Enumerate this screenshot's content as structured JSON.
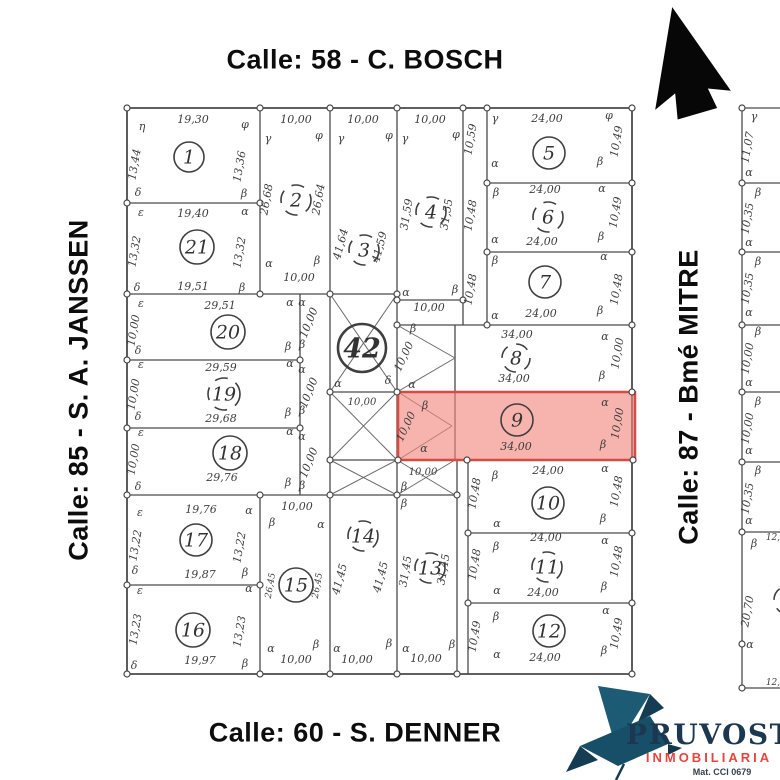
{
  "streets": {
    "top": "Calle: 58 - C. BOSCH",
    "left": "Calle: 85 - S. A. JANSSEN",
    "right": "Calle: 87 - Bmé MITRE",
    "bottom": "Calle: 60 - S. DENNER"
  },
  "logo": {
    "name": "PRUVOST",
    "subtitle": "INMOBILIARIA",
    "registration": "Mat. CCI 0679",
    "navy": "#1c3850",
    "red": "#e8443c",
    "teal": "#1d5a74"
  },
  "icons": {
    "north_arrow": "solid-block-arrow-up",
    "logo_bird": "origami-bird"
  },
  "map": {
    "highlighted_lot": "9",
    "highlight_fill": "#f2857b",
    "highlight_stroke": "#d84b42",
    "line_color": "#4a4a4a",
    "label_color": "#3d3d3d",
    "lots": [
      {
        "n": "1",
        "x": 189,
        "y": 157,
        "r": 15,
        "style": "solid"
      },
      {
        "n": "21",
        "x": 197,
        "y": 247,
        "r": 17,
        "style": "solid"
      },
      {
        "n": "2",
        "x": 296,
        "y": 200,
        "r": 15,
        "style": "dashed"
      },
      {
        "n": "3",
        "x": 364,
        "y": 250,
        "r": 15,
        "style": "dashed"
      },
      {
        "n": "4",
        "x": 431,
        "y": 212,
        "r": 15,
        "style": "dashed"
      },
      {
        "n": "5",
        "x": 549,
        "y": 153,
        "r": 16,
        "style": "solid"
      },
      {
        "n": "6",
        "x": 548,
        "y": 217,
        "r": 15,
        "style": "dashed"
      },
      {
        "n": "7",
        "x": 545,
        "y": 282,
        "r": 16,
        "style": "solid"
      },
      {
        "n": "42",
        "x": 362,
        "y": 348,
        "r": 24,
        "style": "bold"
      },
      {
        "n": "8",
        "x": 516,
        "y": 358,
        "r": 14,
        "style": "dashed"
      },
      {
        "n": "9",
        "x": 517,
        "y": 420,
        "r": 16,
        "style": "solid"
      },
      {
        "n": "10",
        "x": 548,
        "y": 503,
        "r": 16,
        "style": "solid"
      },
      {
        "n": "11",
        "x": 547,
        "y": 567,
        "r": 15,
        "style": "dashed"
      },
      {
        "n": "12",
        "x": 549,
        "y": 631,
        "r": 16,
        "style": "solid"
      },
      {
        "n": "13",
        "x": 430,
        "y": 568,
        "r": 15,
        "style": "dashed"
      },
      {
        "n": "14",
        "x": 363,
        "y": 536,
        "r": 15,
        "style": "dashed"
      },
      {
        "n": "15",
        "x": 296,
        "y": 585,
        "r": 17,
        "style": "solid"
      },
      {
        "n": "16",
        "x": 193,
        "y": 630,
        "r": 17,
        "style": "solid"
      },
      {
        "n": "17",
        "x": 196,
        "y": 540,
        "r": 16,
        "style": "solid"
      },
      {
        "n": "18",
        "x": 230,
        "y": 453,
        "r": 17,
        "style": "solid"
      },
      {
        "n": "19",
        "x": 224,
        "y": 394,
        "r": 16,
        "style": "dashed"
      },
      {
        "n": "20",
        "x": 228,
        "y": 332,
        "r": 17,
        "style": "solid"
      }
    ],
    "labels": [
      {
        "t": "19,30",
        "x": 193,
        "y": 123
      },
      {
        "t": "13,44",
        "x": 138,
        "y": 165,
        "r": -80
      },
      {
        "t": "13,36",
        "x": 243,
        "y": 167,
        "r": -80
      },
      {
        "t": "η",
        "x": 142,
        "y": 130
      },
      {
        "t": "φ",
        "x": 245,
        "y": 128
      },
      {
        "t": "δ",
        "x": 138,
        "y": 196
      },
      {
        "t": "β",
        "x": 244,
        "y": 197
      },
      {
        "t": "19,40",
        "x": 193,
        "y": 217
      },
      {
        "t": "19,51",
        "x": 193,
        "y": 290
      },
      {
        "t": "13,32",
        "x": 138,
        "y": 252,
        "r": -80
      },
      {
        "t": "13,32",
        "x": 243,
        "y": 253,
        "r": -80
      },
      {
        "t": "ε",
        "x": 141,
        "y": 216
      },
      {
        "t": "α",
        "x": 245,
        "y": 215
      },
      {
        "t": "δ",
        "x": 137,
        "y": 291
      },
      {
        "t": "β",
        "x": 242,
        "y": 291
      },
      {
        "t": "10,00",
        "x": 296,
        "y": 123
      },
      {
        "t": "26,68",
        "x": 270,
        "y": 200,
        "r": -80
      },
      {
        "t": "26,64",
        "x": 322,
        "y": 200,
        "r": -80
      },
      {
        "t": "10,00",
        "x": 299,
        "y": 281
      },
      {
        "t": "γ",
        "x": 268,
        "y": 142
      },
      {
        "t": "φ",
        "x": 319,
        "y": 139
      },
      {
        "t": "α",
        "x": 269,
        "y": 267
      },
      {
        "t": "β",
        "x": 317,
        "y": 264
      },
      {
        "t": "10,00",
        "x": 363,
        "y": 123
      },
      {
        "t": "41,64",
        "x": 344,
        "y": 245,
        "r": -75
      },
      {
        "t": "41,59",
        "x": 383,
        "y": 248,
        "r": -75
      },
      {
        "t": "γ",
        "x": 341,
        "y": 142
      },
      {
        "t": "φ",
        "x": 389,
        "y": 139
      },
      {
        "t": "10,00",
        "x": 430,
        "y": 123
      },
      {
        "t": "31,59",
        "x": 410,
        "y": 215,
        "r": -80
      },
      {
        "t": "31,55",
        "x": 450,
        "y": 215,
        "r": -80
      },
      {
        "t": "γ",
        "x": 405,
        "y": 142
      },
      {
        "t": "φ",
        "x": 456,
        "y": 138
      },
      {
        "t": "α",
        "x": 406,
        "y": 296
      },
      {
        "t": "β",
        "x": 455,
        "y": 293
      },
      {
        "t": "10,00",
        "x": 429,
        "y": 311
      },
      {
        "t": "10,59",
        "x": 474,
        "y": 140,
        "r": -80
      },
      {
        "t": "10,48",
        "x": 474,
        "y": 216,
        "r": -80
      },
      {
        "t": "10,48",
        "x": 474,
        "y": 290,
        "r": -80
      },
      {
        "t": "24,00",
        "x": 547,
        "y": 122
      },
      {
        "t": "10,49",
        "x": 620,
        "y": 142,
        "r": -80
      },
      {
        "t": "γ",
        "x": 495,
        "y": 122
      },
      {
        "t": "φ",
        "x": 609,
        "y": 119
      },
      {
        "t": "α",
        "x": 495,
        "y": 167
      },
      {
        "t": "β",
        "x": 600,
        "y": 165
      },
      {
        "t": "24,00",
        "x": 545,
        "y": 193
      },
      {
        "t": "24,00",
        "x": 542,
        "y": 245
      },
      {
        "t": "10,49",
        "x": 619,
        "y": 213,
        "r": -80
      },
      {
        "t": "β",
        "x": 496,
        "y": 196
      },
      {
        "t": "α",
        "x": 602,
        "y": 192
      },
      {
        "t": "α",
        "x": 495,
        "y": 243
      },
      {
        "t": "β",
        "x": 601,
        "y": 240
      },
      {
        "t": "24,00",
        "x": 541,
        "y": 317
      },
      {
        "t": "10,48",
        "x": 620,
        "y": 290,
        "r": -80
      },
      {
        "t": "β",
        "x": 495,
        "y": 264
      },
      {
        "t": "α",
        "x": 604,
        "y": 260
      },
      {
        "t": "α",
        "x": 495,
        "y": 319
      },
      {
        "t": "β",
        "x": 600,
        "y": 314
      },
      {
        "t": "29,51",
        "x": 220,
        "y": 309
      },
      {
        "t": "10,00",
        "x": 137,
        "y": 331,
        "r": -80
      },
      {
        "t": "ε",
        "x": 141,
        "y": 307
      },
      {
        "t": "α",
        "x": 290,
        "y": 306
      },
      {
        "t": "δ",
        "x": 138,
        "y": 354
      },
      {
        "t": "β",
        "x": 288,
        "y": 350
      },
      {
        "t": "α",
        "x": 302,
        "y": 306
      },
      {
        "t": "10,00",
        "x": 312,
        "y": 324,
        "r": -68
      },
      {
        "t": "β",
        "x": 302,
        "y": 348
      },
      {
        "t": "α",
        "x": 302,
        "y": 373
      },
      {
        "t": "10,00",
        "x": 312,
        "y": 394,
        "r": -68
      },
      {
        "t": "β",
        "x": 302,
        "y": 414
      },
      {
        "t": "α",
        "x": 302,
        "y": 440
      },
      {
        "t": "10,00",
        "x": 312,
        "y": 464,
        "r": -68
      },
      {
        "t": "β",
        "x": 302,
        "y": 489
      },
      {
        "t": "29,59",
        "x": 221,
        "y": 371
      },
      {
        "t": "29,68",
        "x": 221,
        "y": 422
      },
      {
        "t": "10,00",
        "x": 137,
        "y": 395,
        "r": -80
      },
      {
        "t": "ε",
        "x": 141,
        "y": 368
      },
      {
        "t": "α",
        "x": 290,
        "y": 367
      },
      {
        "t": "δ",
        "x": 138,
        "y": 420
      },
      {
        "t": "β",
        "x": 288,
        "y": 416
      },
      {
        "t": "29,76",
        "x": 222,
        "y": 481
      },
      {
        "t": "10,00",
        "x": 137,
        "y": 460,
        "r": -80
      },
      {
        "t": "ε",
        "x": 141,
        "y": 436
      },
      {
        "t": "α",
        "x": 290,
        "y": 435
      },
      {
        "t": "δ",
        "x": 138,
        "y": 490
      },
      {
        "t": "β",
        "x": 288,
        "y": 486
      },
      {
        "t": "19,76",
        "x": 201,
        "y": 513
      },
      {
        "t": "19,87",
        "x": 200,
        "y": 578
      },
      {
        "t": "13,22",
        "x": 139,
        "y": 546,
        "r": -80
      },
      {
        "t": "13,22",
        "x": 243,
        "y": 548,
        "r": -80
      },
      {
        "t": "ε",
        "x": 140,
        "y": 516
      },
      {
        "t": "α",
        "x": 249,
        "y": 514
      },
      {
        "t": "δ",
        "x": 135,
        "y": 574
      },
      {
        "t": "β",
        "x": 245,
        "y": 576
      },
      {
        "t": "19,97",
        "x": 200,
        "y": 664
      },
      {
        "t": "13,23",
        "x": 139,
        "y": 630,
        "r": -80
      },
      {
        "t": "13,23",
        "x": 243,
        "y": 632,
        "r": -80
      },
      {
        "t": "ε",
        "x": 140,
        "y": 594
      },
      {
        "t": "α",
        "x": 249,
        "y": 592
      },
      {
        "t": "δ",
        "x": 134,
        "y": 669
      },
      {
        "t": "β",
        "x": 245,
        "y": 667
      },
      {
        "t": "10,00",
        "x": 297,
        "y": 510
      },
      {
        "t": "10,00",
        "x": 296,
        "y": 663
      },
      {
        "t": "26,45",
        "x": 273,
        "y": 586,
        "r": -80,
        "s": 9
      },
      {
        "t": "26,45",
        "x": 320,
        "y": 586,
        "r": -80,
        "s": 9
      },
      {
        "t": "β",
        "x": 272,
        "y": 526
      },
      {
        "t": "α",
        "x": 321,
        "y": 528
      },
      {
        "t": "α",
        "x": 271,
        "y": 652
      },
      {
        "t": "β",
        "x": 316,
        "y": 648
      },
      {
        "t": "41,45",
        "x": 343,
        "y": 580,
        "r": -75
      },
      {
        "t": "41,45",
        "x": 384,
        "y": 578,
        "r": -75
      },
      {
        "t": "10,00",
        "x": 357,
        "y": 663
      },
      {
        "t": "α",
        "x": 337,
        "y": 652
      },
      {
        "t": "β",
        "x": 389,
        "y": 647
      },
      {
        "t": "31,45",
        "x": 409,
        "y": 572,
        "r": -80
      },
      {
        "t": "31,45",
        "x": 447,
        "y": 570,
        "r": -80
      },
      {
        "t": "10,00",
        "x": 426,
        "y": 662
      },
      {
        "t": "β",
        "x": 404,
        "y": 507
      },
      {
        "t": "α",
        "x": 406,
        "y": 652
      },
      {
        "t": "β",
        "x": 452,
        "y": 648
      },
      {
        "t": "α",
        "x": 338,
        "y": 387
      },
      {
        "t": "δ",
        "x": 388,
        "y": 384
      },
      {
        "t": "10,00",
        "x": 362,
        "y": 405,
        "s": 10
      },
      {
        "t": "β",
        "x": 413,
        "y": 332
      },
      {
        "t": "10,00",
        "x": 407,
        "y": 358,
        "r": -65
      },
      {
        "t": "α",
        "x": 412,
        "y": 388
      },
      {
        "t": "β",
        "x": 425,
        "y": 409
      },
      {
        "t": "10,00",
        "x": 409,
        "y": 428,
        "r": -65
      },
      {
        "t": "α",
        "x": 424,
        "y": 452
      },
      {
        "t": "10,00",
        "x": 423,
        "y": 475,
        "s": 10
      },
      {
        "t": "β",
        "x": 404,
        "y": 490
      },
      {
        "t": "34,00",
        "x": 517,
        "y": 338
      },
      {
        "t": "34,00",
        "x": 514,
        "y": 382
      },
      {
        "t": "10,00",
        "x": 621,
        "y": 354,
        "r": -80
      },
      {
        "t": "α",
        "x": 605,
        "y": 340
      },
      {
        "t": "β",
        "x": 602,
        "y": 379
      },
      {
        "t": "34,00",
        "x": 516,
        "y": 450
      },
      {
        "t": "10,00",
        "x": 621,
        "y": 424,
        "r": -80
      },
      {
        "t": "α",
        "x": 605,
        "y": 406
      },
      {
        "t": "β",
        "x": 603,
        "y": 448
      },
      {
        "t": "24,00",
        "x": 548,
        "y": 474
      },
      {
        "t": "10,48",
        "x": 478,
        "y": 494,
        "r": -80
      },
      {
        "t": "10,48",
        "x": 620,
        "y": 492,
        "r": -80
      },
      {
        "t": "β",
        "x": 495,
        "y": 479
      },
      {
        "t": "α",
        "x": 605,
        "y": 472
      },
      {
        "t": "α",
        "x": 497,
        "y": 527
      },
      {
        "t": "β",
        "x": 603,
        "y": 522
      },
      {
        "t": "24,00",
        "x": 546,
        "y": 541
      },
      {
        "t": "24,00",
        "x": 543,
        "y": 596
      },
      {
        "t": "10,48",
        "x": 478,
        "y": 565,
        "r": -80
      },
      {
        "t": "10,48",
        "x": 620,
        "y": 562,
        "r": -80
      },
      {
        "t": "β",
        "x": 496,
        "y": 550
      },
      {
        "t": "α",
        "x": 605,
        "y": 544
      },
      {
        "t": "α",
        "x": 497,
        "y": 594
      },
      {
        "t": "β",
        "x": 604,
        "y": 590
      },
      {
        "t": "24,00",
        "x": 545,
        "y": 661
      },
      {
        "t": "10,49",
        "x": 478,
        "y": 637,
        "r": -80
      },
      {
        "t": "10,49",
        "x": 620,
        "y": 634,
        "r": -80
      },
      {
        "t": "β",
        "x": 496,
        "y": 620
      },
      {
        "t": "α",
        "x": 606,
        "y": 614
      },
      {
        "t": "α",
        "x": 497,
        "y": 658
      },
      {
        "t": "β",
        "x": 604,
        "y": 654
      },
      {
        "t": "γ",
        "x": 754,
        "y": 120
      },
      {
        "t": "11,07",
        "x": 751,
        "y": 148,
        "r": -80
      },
      {
        "t": "α",
        "x": 749,
        "y": 176
      },
      {
        "t": "β",
        "x": 758,
        "y": 196
      },
      {
        "t": "10,35",
        "x": 751,
        "y": 219,
        "r": -80
      },
      {
        "t": "α",
        "x": 749,
        "y": 246
      },
      {
        "t": "β",
        "x": 758,
        "y": 265
      },
      {
        "t": "10,35",
        "x": 751,
        "y": 289,
        "r": -80
      },
      {
        "t": "α",
        "x": 749,
        "y": 316
      },
      {
        "t": "β",
        "x": 758,
        "y": 335
      },
      {
        "t": "10,00",
        "x": 751,
        "y": 359,
        "r": -80
      },
      {
        "t": "α",
        "x": 749,
        "y": 386
      },
      {
        "t": "β",
        "x": 758,
        "y": 405
      },
      {
        "t": "10,00",
        "x": 751,
        "y": 429,
        "r": -80
      },
      {
        "t": "α",
        "x": 749,
        "y": 454
      },
      {
        "t": "β",
        "x": 758,
        "y": 474
      },
      {
        "t": "10,35",
        "x": 751,
        "y": 499,
        "r": -80
      },
      {
        "t": "α",
        "x": 749,
        "y": 524
      },
      {
        "t": "β",
        "x": 754,
        "y": 547
      },
      {
        "t": "20,70",
        "x": 751,
        "y": 612,
        "r": -80
      },
      {
        "t": "α",
        "x": 750,
        "y": 648
      },
      {
        "t": "12,",
        "x": 773,
        "y": 540,
        "s": 9
      },
      {
        "t": "12,",
        "x": 773,
        "y": 685,
        "s": 9
      }
    ]
  }
}
